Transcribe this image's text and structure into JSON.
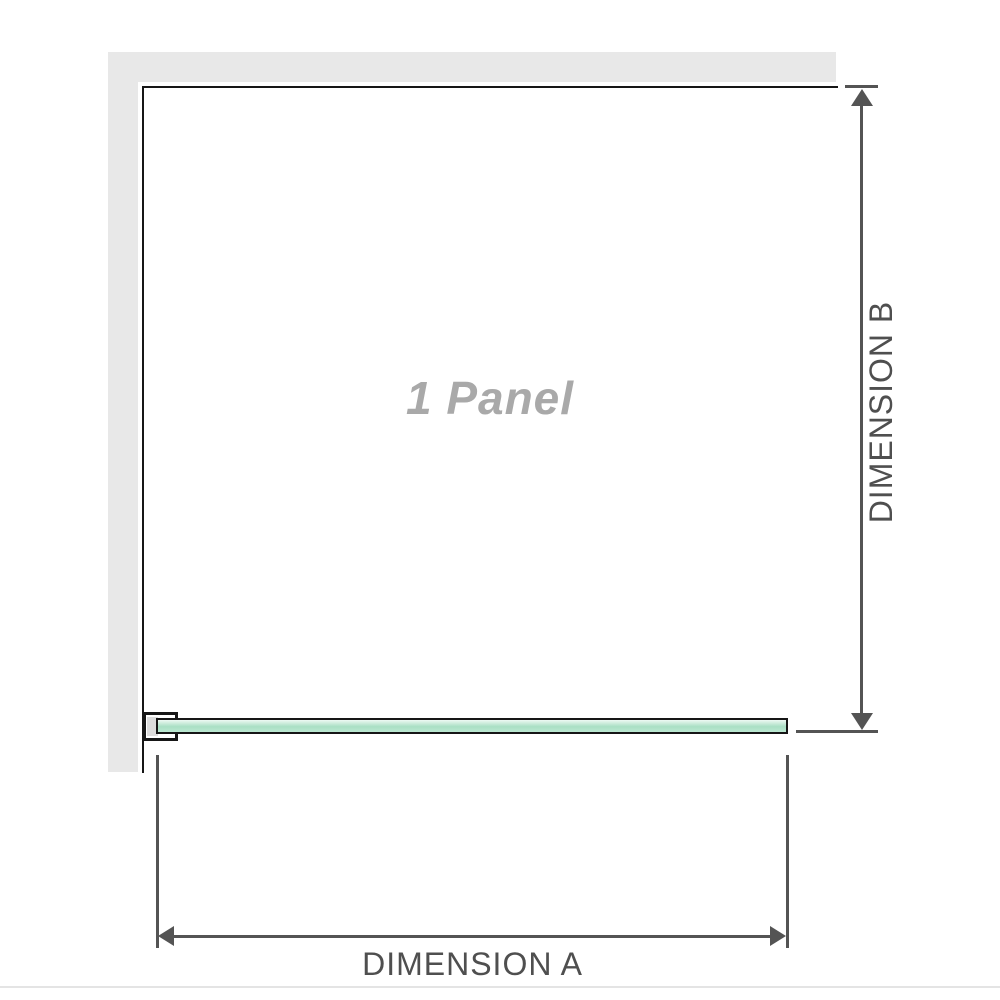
{
  "diagram": {
    "panel_label": "1 Panel",
    "dimension_a": {
      "label": "DIMENSION A"
    },
    "dimension_b": {
      "label": "DIMENSION B"
    }
  },
  "icons": {
    "dimension_b_arrows": "double-headed-vertical-arrow",
    "dimension_a_arrows": "double-headed-horizontal-arrow"
  },
  "colors": {
    "wall": "#e8e8e8",
    "line": "#545454",
    "panel-border": "#161616",
    "dim-text": "#4f4f4f",
    "panel-label": "#a9a9a9",
    "glass-border": "#161616",
    "glass-top": "#eef9f3",
    "glass-mid": "#a9dfc4",
    "glass-low": "#bce8d2",
    "bracket-pad": "#dcdcdc",
    "divider": "#e4e4e4"
  }
}
